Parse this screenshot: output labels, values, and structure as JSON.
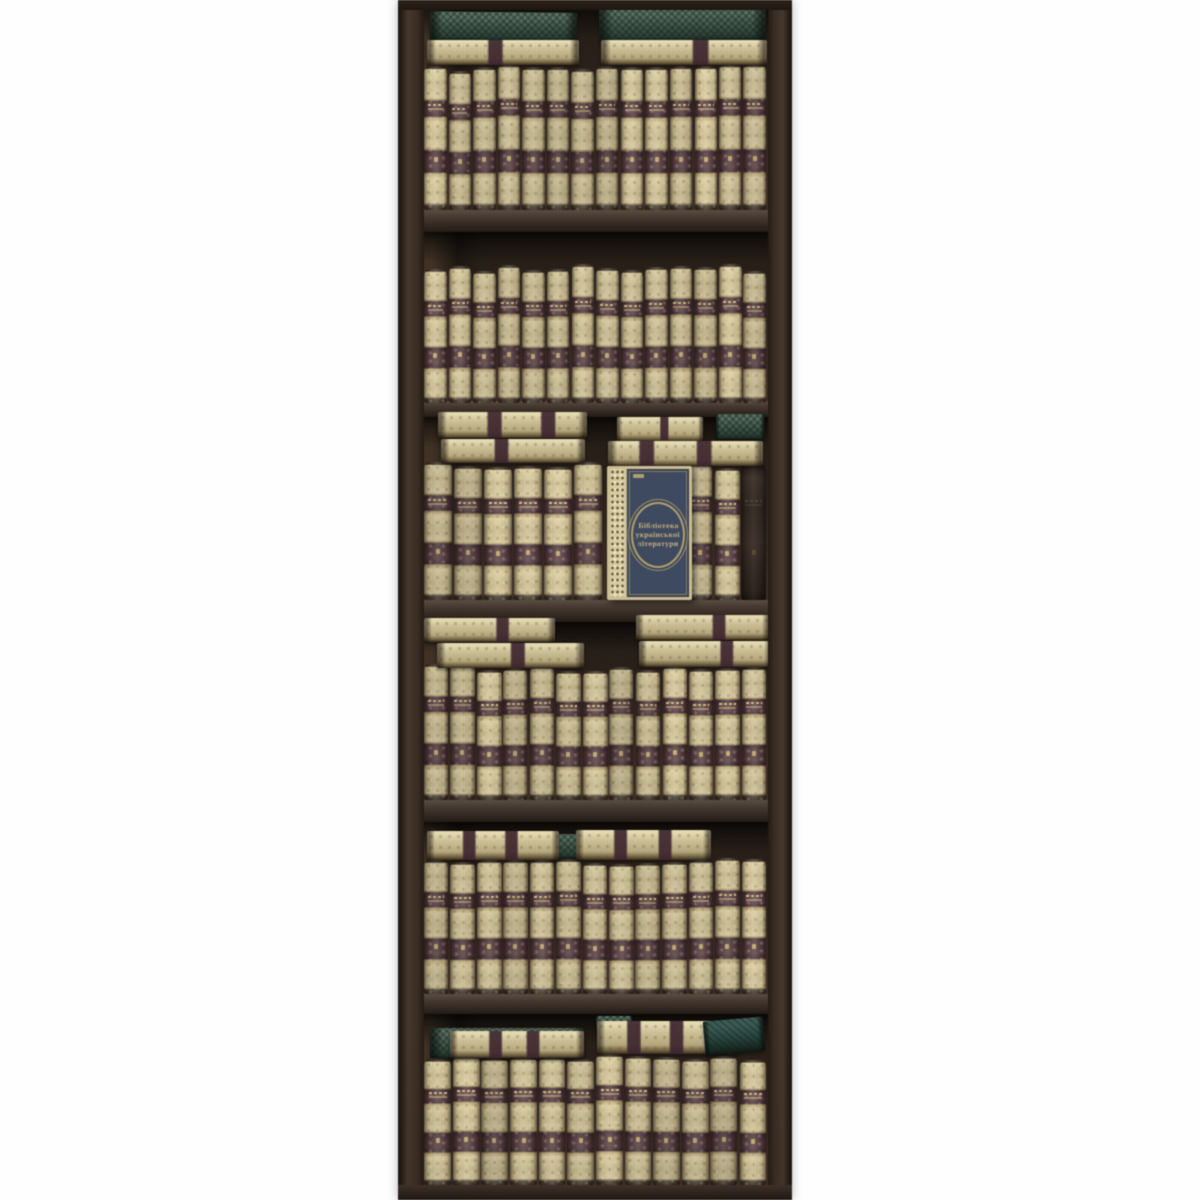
{
  "meta": {
    "type": "photograph",
    "subject": "Tall narrow dark-brown bookcase panel with six shelves densely filled with antique cream-and-gold leather book spines with burgundy title bands; stacked flat volumes and green cloth books on several shelves; one dark-blue decorated volume faces outward on the third shelf",
    "background_color": "#ffffff"
  },
  "palette": {
    "frame_brown": "#3a2d23",
    "interior_shadow": "#221a13",
    "spine_gold": "#c6b88a",
    "spine_gold_light": "#e0d5a9",
    "band_maroon": "#4a3039",
    "gold_accent": "#cdb273",
    "green_cover": "#42594c",
    "teal_cover": "#274540",
    "blue_cover": "#3d4a62",
    "blue_frame_gold": "#cfc096"
  },
  "blue_book": {
    "title_lines": [
      "Бібліотека",
      "української",
      "літератури"
    ],
    "cover_color": "#3d4a62",
    "medallion": "oval gold double ring",
    "ornament": "floral gilt strip on left edge"
  },
  "scene": {
    "case": {
      "x": 398,
      "w": 394,
      "interior_x": 420,
      "interior_w": 350
    },
    "compartments": [
      {
        "y": 8,
        "h": 202
      },
      {
        "y": 232,
        "h": 169
      },
      {
        "y": 417,
        "h": 183
      },
      {
        "y": 622,
        "h": 178
      },
      {
        "y": 822,
        "h": 172
      },
      {
        "y": 1014,
        "h": 171
      }
    ],
    "boards": [
      {
        "y": 210,
        "h": 22
      },
      {
        "y": 401,
        "h": 16
      },
      {
        "y": 600,
        "h": 22
      },
      {
        "y": 800,
        "h": 22
      },
      {
        "y": 994,
        "h": 20
      }
    ],
    "rows": [
      {
        "x": 424,
        "y": 64,
        "w": 344,
        "h": 146,
        "count": 14
      },
      {
        "x": 424,
        "y": 264,
        "w": 344,
        "h": 139,
        "count": 14
      },
      {
        "x": 424,
        "y": 461,
        "w": 180,
        "h": 139,
        "count": 6
      },
      {
        "x": 688,
        "y": 461,
        "w": 80,
        "h": 139,
        "count": 3,
        "last_dark": true
      },
      {
        "x": 424,
        "y": 664,
        "w": 344,
        "h": 136,
        "count": 13
      },
      {
        "x": 424,
        "y": 858,
        "w": 344,
        "h": 136,
        "count": 13
      },
      {
        "x": 424,
        "y": 1054,
        "w": 344,
        "h": 131,
        "count": 12
      }
    ],
    "flats": [
      {
        "kind": "green",
        "x": 430,
        "y": 12,
        "w": 147,
        "h": 29,
        "rot": 0.6
      },
      {
        "kind": "gold",
        "x": 427,
        "y": 40,
        "w": 152,
        "h": 25,
        "stripes": [
          0.45
        ]
      },
      {
        "kind": "green",
        "x": 599,
        "y": 8,
        "w": 167,
        "h": 33,
        "rot": -0.8
      },
      {
        "kind": "gold",
        "x": 601,
        "y": 40,
        "w": 166,
        "h": 25,
        "stripes": [
          0.6
        ]
      },
      {
        "kind": "gold",
        "x": 438,
        "y": 412,
        "w": 149,
        "h": 26,
        "stripes": [
          0.38,
          0.74
        ]
      },
      {
        "kind": "gold",
        "x": 441,
        "y": 439,
        "w": 144,
        "h": 24,
        "stripes": [
          0.42
        ]
      },
      {
        "kind": "gold",
        "x": 617,
        "y": 417,
        "w": 86,
        "h": 24,
        "stripes": [
          0.55
        ]
      },
      {
        "kind": "green",
        "x": 716,
        "y": 414,
        "w": 48,
        "h": 25
      },
      {
        "kind": "gold",
        "x": 608,
        "y": 441,
        "w": 155,
        "h": 25,
        "stripes": [
          0.25,
          0.62
        ]
      },
      {
        "kind": "gold",
        "x": 424,
        "y": 618,
        "w": 131,
        "h": 24,
        "stripes": [
          0.6
        ]
      },
      {
        "kind": "gold",
        "x": 437,
        "y": 643,
        "w": 147,
        "h": 25,
        "stripes": [
          0.55
        ]
      },
      {
        "kind": "gold",
        "x": 636,
        "y": 615,
        "w": 134,
        "h": 25,
        "stripes": [
          0.62
        ]
      },
      {
        "kind": "gold",
        "x": 639,
        "y": 641,
        "w": 133,
        "h": 26,
        "stripes": [
          0.66
        ]
      },
      {
        "kind": "green",
        "x": 556,
        "y": 834,
        "w": 24,
        "h": 24
      },
      {
        "kind": "gold",
        "x": 427,
        "y": 831,
        "w": 132,
        "h": 29,
        "stripes": [
          0.32,
          0.64
        ]
      },
      {
        "kind": "gold",
        "x": 576,
        "y": 830,
        "w": 135,
        "h": 30,
        "stripes": [
          0.33,
          0.66
        ]
      },
      {
        "kind": "green",
        "x": 430,
        "y": 1028,
        "w": 154,
        "h": 30
      },
      {
        "kind": "gold",
        "x": 450,
        "y": 1031,
        "w": 134,
        "h": 27,
        "stripes": [
          0.34,
          0.62
        ]
      },
      {
        "kind": "green",
        "x": 596,
        "y": 1016,
        "w": 36,
        "h": 16
      },
      {
        "kind": "gold",
        "x": 597,
        "y": 1021,
        "w": 142,
        "h": 33,
        "stripes": [
          0.26,
          0.56
        ]
      },
      {
        "kind": "teal",
        "x": 704,
        "y": 1019,
        "w": 60,
        "h": 34,
        "rot": -5
      }
    ]
  }
}
